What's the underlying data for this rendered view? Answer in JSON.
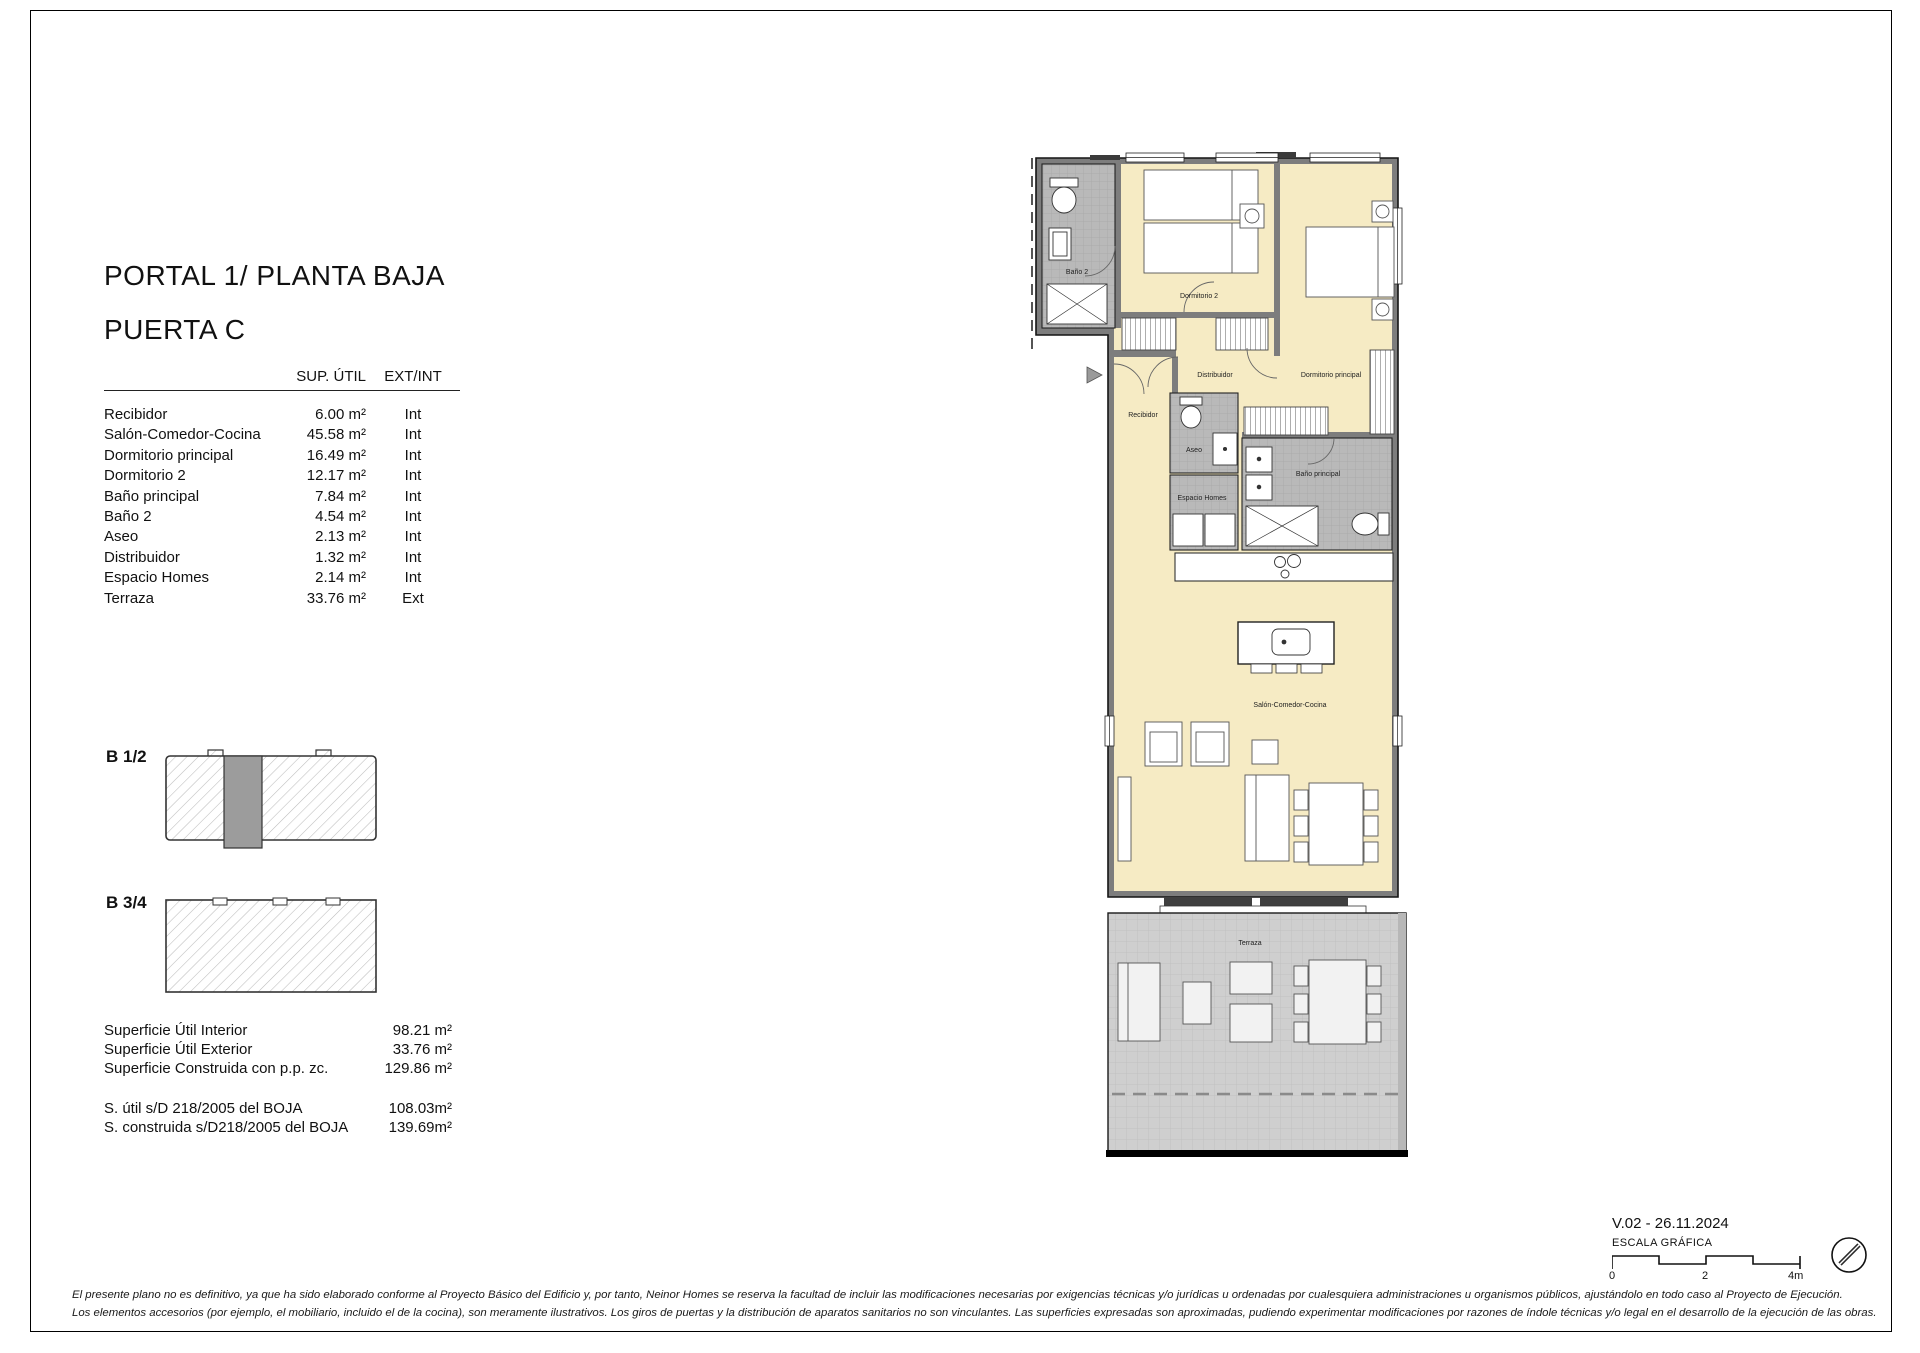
{
  "header": {
    "title_line1": "PORTAL 1/ PLANTA BAJA",
    "title_line2": "PUERTA C"
  },
  "area_table": {
    "col_area": "SUP. ÚTIL",
    "col_extint": "EXT/INT",
    "rows": [
      {
        "name": "Recibidor",
        "area": "6.00 m²",
        "type": "Int"
      },
      {
        "name": "Salón-Comedor-Cocina",
        "area": "45.58 m²",
        "type": "Int"
      },
      {
        "name": "Dormitorio principal",
        "area": "16.49 m²",
        "type": "Int"
      },
      {
        "name": "Dormitorio 2",
        "area": "12.17 m²",
        "type": "Int"
      },
      {
        "name": "Baño principal",
        "area": "7.84 m²",
        "type": "Int"
      },
      {
        "name": "Baño 2",
        "area": "4.54 m²",
        "type": "Int"
      },
      {
        "name": "Aseo",
        "area": "2.13 m²",
        "type": "Int"
      },
      {
        "name": "Distribuidor",
        "area": "1.32 m²",
        "type": "Int"
      },
      {
        "name": "Espacio Homes",
        "area": "2.14 m²",
        "type": "Int"
      },
      {
        "name": "Terraza",
        "area": "33.76 m²",
        "type": "Ext"
      }
    ]
  },
  "key_plans": {
    "plan1_label": "B 1/2",
    "plan2_label": "B 3/4"
  },
  "summary": {
    "rows": [
      {
        "label": "Superficie Útil Interior",
        "value": "98.21 m²"
      },
      {
        "label": "Superficie Útil Exterior",
        "value": "33.76 m²"
      },
      {
        "label": "Superficie Construida con p.p. zc.",
        "value": "129.86 m²"
      }
    ],
    "boja_rows": [
      {
        "label": "S. útil s/D 218/2005 del BOJA",
        "value": "108.03m²"
      },
      {
        "label": "S. construida s/D218/2005 del BOJA",
        "value": "139.69m²"
      }
    ]
  },
  "floor_plan": {
    "room_labels": {
      "bano2": "Baño 2",
      "dormitorio2": "Dormitorio 2",
      "dormitorio_principal": "Dormitorio principal",
      "distribuidor": "Distribuidor",
      "recibidor": "Recibidor",
      "aseo": "Aseo",
      "espacio_homes": "Espacio Homes",
      "bano_principal": "Baño principal",
      "salon": "Salón-Comedor-Cocina",
      "terraza": "Terraza"
    },
    "colors": {
      "room_fill": "#f6ebc4",
      "wet_fill": "#b9b9b9",
      "terrace_fill": "#cfcfcf",
      "wall": "#7d7d7d"
    }
  },
  "footer": {
    "version": "V.02 - 26.11.2024",
    "scale_label": "ESCALA GRÁFICA",
    "tick0": "0",
    "tick2": "2",
    "tick4": "4m",
    "disclaimer_line1": "El presente plano no es definitivo, ya que ha sido elaborado conforme al Proyecto Básico del Edificio y, por tanto, Neinor Homes se reserva la facultad de incluir las modificaciones necesarias por exigencias técnicas y/o jurídicas u ordenadas por cualesquiera administraciones u organismos públicos, ajustándolo en todo caso al Proyecto de Ejecución.",
    "disclaimer_line2": "Los elementos accesorios (por ejemplo, el mobiliario, incluido el de la cocina), son meramente ilustrativos. Los giros de puertas y la distribución de aparatos sanitarios no son vinculantes. Las superficies expresadas son aproximadas, pudiendo experimentar modificaciones por razones de índole técnicas y/o legal en el desarrollo de la ejecución de las obras."
  }
}
